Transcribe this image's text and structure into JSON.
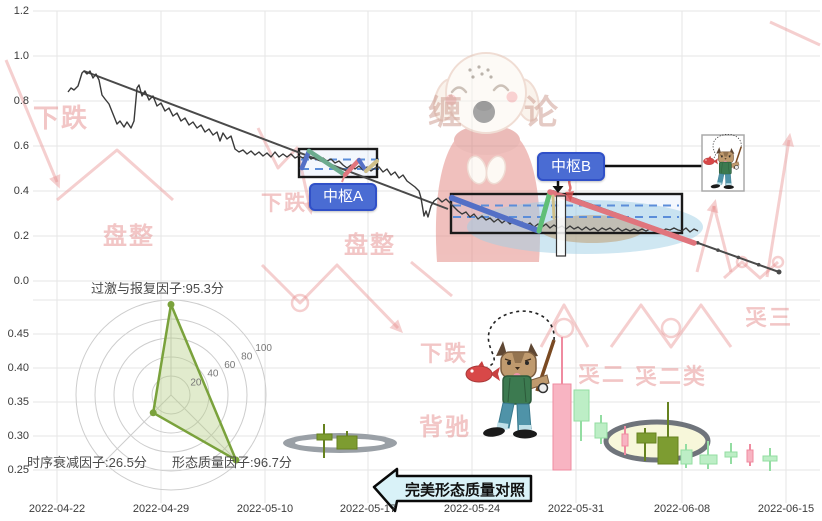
{
  "axes": {
    "x_labels": [
      "2022-04-22",
      "2022-04-29",
      "2022-05-10",
      "2022-05-17",
      "2022-05-24",
      "2022-05-31",
      "2022-06-08",
      "2022-06-15"
    ],
    "x_centers": [
      57,
      161,
      265,
      368,
      472,
      576,
      682,
      786
    ],
    "top_y": {
      "ticks": [
        "1.2",
        "1.0",
        "0.8",
        "0.6",
        "0.4",
        "0.2",
        "0.0"
      ],
      "tick_y": [
        11,
        56,
        101,
        146,
        191,
        236,
        281
      ],
      "range": [
        0,
        1.2
      ]
    },
    "bottom_y": {
      "ticks": [
        "0.45",
        "0.40",
        "0.35",
        "0.30",
        "0.25"
      ],
      "tick_y": [
        334,
        368,
        402,
        436,
        470
      ],
      "extra_grid_y": [
        300
      ]
    },
    "grid_top": 11,
    "grid_bottom": 503,
    "grid_left": 33,
    "grid_right": 820
  },
  "labels": {
    "pivot_a": "中枢A",
    "pivot_b": "中枢B",
    "arrow_callout": "完美形态质量对照",
    "brand_left": "缠",
    "brand_right": "论"
  },
  "chart_data": {
    "type": "line",
    "title": "",
    "y_range": [
      0,
      1.2
    ],
    "price_polyline_px": [
      [
        68,
        92
      ],
      [
        71,
        88
      ],
      [
        74,
        90
      ],
      [
        78,
        86
      ],
      [
        82,
        73
      ],
      [
        84,
        71
      ],
      [
        87,
        74
      ],
      [
        90,
        71
      ],
      [
        93,
        78
      ],
      [
        96,
        74
      ],
      [
        99,
        80
      ],
      [
        102,
        95
      ],
      [
        105,
        99
      ],
      [
        109,
        104
      ],
      [
        113,
        114
      ],
      [
        117,
        124
      ],
      [
        120,
        121
      ],
      [
        124,
        127
      ],
      [
        127,
        122
      ],
      [
        131,
        128
      ],
      [
        134,
        121
      ],
      [
        137,
        88
      ],
      [
        139,
        85
      ],
      [
        142,
        96
      ],
      [
        145,
        91
      ],
      [
        149,
        100
      ],
      [
        153,
        96
      ],
      [
        157,
        106
      ],
      [
        161,
        103
      ],
      [
        165,
        111
      ],
      [
        169,
        108
      ],
      [
        173,
        116
      ],
      [
        177,
        113
      ],
      [
        181,
        121
      ],
      [
        185,
        118
      ],
      [
        189,
        125
      ],
      [
        193,
        122
      ],
      [
        197,
        128
      ],
      [
        201,
        125
      ],
      [
        205,
        132
      ],
      [
        209,
        129
      ],
      [
        213,
        135
      ],
      [
        217,
        132
      ],
      [
        220,
        141
      ],
      [
        223,
        133
      ],
      [
        227,
        139
      ],
      [
        231,
        136
      ],
      [
        235,
        149
      ],
      [
        239,
        152
      ],
      [
        243,
        150
      ],
      [
        247,
        154
      ],
      [
        251,
        151
      ],
      [
        255,
        155
      ],
      [
        259,
        152
      ],
      [
        263,
        156
      ],
      [
        267,
        153
      ],
      [
        271,
        157
      ],
      [
        275,
        152
      ],
      [
        279,
        157
      ],
      [
        283,
        154
      ],
      [
        287,
        157
      ],
      [
        291,
        154
      ],
      [
        295,
        158
      ],
      [
        299,
        156
      ],
      [
        303,
        158
      ],
      [
        307,
        155
      ],
      [
        311,
        159
      ],
      [
        315,
        157
      ],
      [
        319,
        160
      ],
      [
        323,
        158
      ],
      [
        327,
        161
      ],
      [
        331,
        159
      ],
      [
        335,
        163
      ],
      [
        339,
        161
      ],
      [
        343,
        165
      ],
      [
        347,
        168
      ],
      [
        351,
        165
      ],
      [
        355,
        169
      ],
      [
        359,
        166
      ],
      [
        363,
        170
      ],
      [
        367,
        167
      ],
      [
        371,
        171
      ],
      [
        375,
        168
      ],
      [
        379,
        167
      ],
      [
        383,
        172
      ],
      [
        387,
        169
      ],
      [
        391,
        175
      ],
      [
        395,
        172
      ],
      [
        399,
        178
      ],
      [
        403,
        175
      ],
      [
        407,
        181
      ],
      [
        411,
        184
      ],
      [
        415,
        187
      ],
      [
        419,
        191
      ],
      [
        421,
        198
      ],
      [
        424,
        216
      ],
      [
        426,
        211
      ],
      [
        428,
        217
      ],
      [
        431,
        206
      ],
      [
        434,
        201
      ],
      [
        438,
        198
      ],
      [
        442,
        202
      ],
      [
        446,
        199
      ],
      [
        450,
        203
      ],
      [
        454,
        207
      ],
      [
        458,
        211
      ],
      [
        462,
        214
      ],
      [
        466,
        212
      ],
      [
        470,
        217
      ],
      [
        474,
        214
      ],
      [
        478,
        219
      ],
      [
        482,
        216
      ],
      [
        486,
        220
      ],
      [
        490,
        218
      ],
      [
        494,
        222
      ],
      [
        498,
        219
      ],
      [
        502,
        223
      ],
      [
        506,
        220
      ],
      [
        510,
        224
      ],
      [
        514,
        221
      ],
      [
        518,
        225
      ],
      [
        522,
        222
      ],
      [
        526,
        226
      ],
      [
        530,
        223
      ],
      [
        534,
        227
      ],
      [
        538,
        224
      ],
      [
        542,
        227
      ],
      [
        546,
        224
      ],
      [
        550,
        228
      ],
      [
        554,
        225
      ],
      [
        558,
        228
      ],
      [
        562,
        226
      ],
      [
        566,
        229
      ],
      [
        570,
        226
      ],
      [
        574,
        229
      ],
      [
        578,
        227
      ],
      [
        582,
        230
      ],
      [
        586,
        227
      ],
      [
        590,
        230
      ],
      [
        594,
        228
      ],
      [
        598,
        231
      ],
      [
        602,
        228
      ],
      [
        606,
        230
      ],
      [
        610,
        228
      ],
      [
        614,
        231
      ],
      [
        618,
        228
      ],
      [
        622,
        231
      ],
      [
        626,
        229
      ],
      [
        630,
        231
      ],
      [
        634,
        229
      ],
      [
        638,
        231
      ],
      [
        642,
        229
      ],
      [
        646,
        231
      ],
      [
        650,
        229
      ],
      [
        654,
        231
      ],
      [
        658,
        229
      ],
      [
        662,
        231
      ],
      [
        666,
        229
      ],
      [
        670,
        230
      ],
      [
        674,
        228
      ],
      [
        678,
        230
      ],
      [
        682,
        231
      ],
      [
        686,
        228
      ],
      [
        690,
        232
      ],
      [
        694,
        229
      ],
      [
        698,
        231
      ]
    ],
    "trendlines": [
      {
        "from": [
          84,
          71
        ],
        "to": [
          448,
          209
        ],
        "markers": false
      },
      {
        "from": [
          553,
          191
        ],
        "to": [
          779,
          272
        ],
        "markers": true
      }
    ],
    "segments": [
      {
        "c": "blue",
        "w": 4.5,
        "pts": [
          [
            302,
            168
          ],
          [
            309,
            151
          ]
        ]
      },
      {
        "c": "teal",
        "w": 4.5,
        "pts": [
          [
            309,
            151
          ],
          [
            345,
            175
          ]
        ]
      },
      {
        "c": "red_seg",
        "w": 4.5,
        "pts": [
          [
            345,
            175
          ],
          [
            359,
            160
          ]
        ]
      },
      {
        "c": "blue",
        "w": 4,
        "pts": [
          [
            359,
            160
          ],
          [
            366,
            171
          ]
        ]
      },
      {
        "c": "khaki",
        "w": 4,
        "pts": [
          [
            366,
            171
          ],
          [
            377,
            161
          ]
        ]
      },
      {
        "c": "blue",
        "w": 5.5,
        "pts": [
          [
            452,
            198
          ],
          [
            539,
            231
          ]
        ]
      },
      {
        "c": "green_seg",
        "w": 5,
        "pts": [
          [
            539,
            231
          ],
          [
            550,
            192
          ]
        ]
      },
      {
        "c": "red_seg",
        "w": 5.5,
        "pts": [
          [
            550,
            192
          ],
          [
            694,
            243
          ]
        ]
      },
      {
        "c": "khaki",
        "w": 3,
        "pts": [
          [
            553,
            196
          ],
          [
            554,
            218
          ]
        ]
      }
    ],
    "pivot_boxes": [
      {
        "name": "中枢A",
        "x": 299,
        "y": 149,
        "w": 78,
        "h": 28,
        "dash_y": [
          159.5,
          169
        ],
        "dash_x": [
          301,
          383
        ]
      },
      {
        "name": "中枢B",
        "x": 451,
        "y": 194,
        "w": 231,
        "h": 39,
        "dash_y": [
          205.5,
          217
        ],
        "dash_x": [
          453,
          679
        ]
      }
    ],
    "ellipses": [
      {
        "cx": 585,
        "cy": 227,
        "rx": 118,
        "ry": 27,
        "fill": "#9fcfe6",
        "op": 0.5
      },
      {
        "cx": 592,
        "cy": 229,
        "rx": 52,
        "ry": 14,
        "fill": "#bf9e72",
        "op": 0.55
      }
    ],
    "narrow_rect": {
      "x": 556.5,
      "y": 196,
      "w": 9,
      "h": 60
    },
    "mini_frame": {
      "x": 702,
      "y": 135,
      "w": 42,
      "h": 56
    },
    "candles": [
      {
        "cls": "pink",
        "b": [
          553,
          384,
          18,
          86
        ],
        "w": [
          562,
          337,
          384
        ]
      },
      {
        "cls": "lgreen",
        "b": [
          574,
          390,
          15,
          31
        ],
        "w": [
          581,
          421,
          441
        ]
      },
      {
        "cls": "lgreen",
        "b": [
          595,
          423,
          12,
          15
        ],
        "w": [
          601,
          415,
          444
        ]
      },
      {
        "cls": "pink",
        "b": [
          622,
          434,
          6,
          12
        ],
        "w": [
          625,
          426,
          455
        ]
      },
      {
        "cls": "olive",
        "b": [
          637,
          433,
          19,
          10
        ],
        "w": [
          645,
          428,
          461
        ]
      },
      {
        "cls": "olive",
        "b": [
          658,
          437,
          20,
          27
        ],
        "w": [
          668,
          402,
          437
        ]
      },
      {
        "cls": "lgreen",
        "b": [
          681,
          450,
          11,
          14
        ],
        "w": [
          686,
          444,
          468
        ]
      },
      {
        "cls": "lgreen",
        "b": [
          700,
          455,
          17,
          9
        ],
        "w": [
          708,
          441,
          469
        ]
      },
      {
        "cls": "lgreen",
        "b": [
          725,
          452,
          12,
          5
        ],
        "w": [
          731,
          443,
          464
        ]
      },
      {
        "cls": "pink",
        "b": [
          747,
          450,
          6,
          12
        ],
        "w": [
          750,
          444,
          466
        ]
      },
      {
        "cls": "lgreen",
        "b": [
          763,
          456,
          14,
          5
        ],
        "w": [
          770,
          448,
          471
        ]
      },
      {
        "cls": "olive",
        "b": [
          317,
          434,
          15,
          6
        ],
        "w": [
          324,
          424,
          458
        ]
      },
      {
        "cls": "olive",
        "b": [
          337,
          436,
          20,
          13
        ],
        "w": [
          347,
          431,
          436
        ]
      }
    ],
    "gray_ring_left": {
      "cx": 340,
      "cy": 443,
      "rx": 57,
      "ry": 10,
      "inner_rx": 45,
      "inner_ry": 4.5
    },
    "gray_ellipse_right": {
      "cx": 657,
      "cy": 441,
      "rx": 51,
      "ry": 19
    },
    "radar": {
      "center": [
        171,
        395
      ],
      "px_per_unit": 0.95,
      "rings": [
        20,
        40,
        60,
        80,
        100
      ],
      "tick_angle_deg": -27,
      "factors": [
        {
          "label": "过激与报复因子:95.3分",
          "value": 95.3,
          "angle": -90,
          "label_x": 91,
          "label_y": 278
        },
        {
          "label": "形态质量因子:96.7分",
          "value": 96.7,
          "angle": 45,
          "label_x": 172,
          "label_y": 452
        },
        {
          "label": "时序衰减因子:26.5分",
          "value": 26.5,
          "angle": 135,
          "label_x": 27,
          "label_y": 452
        }
      ]
    },
    "callout": {
      "poly": "374,487 397,469 397,476 531,476 531,501 397,501 395,511"
    }
  },
  "watermark_texts": [
    {
      "text": "下跌",
      "x": 33,
      "y": 98,
      "size": 26,
      "mirror": false
    },
    {
      "text": "盘整",
      "x": 103,
      "y": 216,
      "size": 24,
      "mirror": false
    },
    {
      "text": "下跌",
      "x": 261,
      "y": 187,
      "size": 21,
      "mirror": false
    },
    {
      "text": "盘整",
      "x": 344,
      "y": 225,
      "size": 24,
      "mirror": false
    },
    {
      "text": "下跌",
      "x": 420,
      "y": 336,
      "size": 22,
      "mirror": false
    },
    {
      "text": "背驰",
      "x": 419,
      "y": 407,
      "size": 24,
      "mirror": false
    },
    {
      "text": "二买",
      "x": 576,
      "y": 357,
      "size": 22,
      "mirror": true
    },
    {
      "text": "类二买",
      "x": 633,
      "y": 359,
      "size": 22,
      "mirror": true
    },
    {
      "text": "三买",
      "x": 743,
      "y": 300,
      "size": 22,
      "mirror": true
    }
  ],
  "watermark_shapes": {
    "polylines": [
      {
        "pts": [
          [
            6,
            60
          ],
          [
            57,
            182
          ]
        ],
        "arrow": true
      },
      {
        "pts": [
          [
            57,
            200
          ],
          [
            117,
            150
          ],
          [
            173,
            200
          ]
        ],
        "arrow": false
      },
      {
        "pts": [
          [
            258,
            128
          ],
          [
            278,
            168
          ],
          [
            297,
            148
          ],
          [
            310,
            208
          ]
        ],
        "arrow": true
      },
      {
        "pts": [
          [
            697,
            272
          ],
          [
            714,
            206
          ]
        ],
        "arrow": true
      },
      {
        "pts": [
          [
            714,
            206
          ],
          [
            731,
            272
          ]
        ],
        "arrow": false
      },
      {
        "pts": [
          [
            767,
            277
          ],
          [
            789,
            140
          ]
        ],
        "arrow": true
      },
      {
        "pts": [
          [
            770,
            22
          ],
          [
            820,
            45
          ]
        ],
        "arrow": false
      },
      {
        "pts": [
          [
            262,
            265
          ],
          [
            300,
            303
          ],
          [
            337,
            265
          ],
          [
            398,
            328
          ]
        ],
        "arrow": true
      },
      {
        "pts": [
          [
            541,
            347
          ],
          [
            564,
            305
          ],
          [
            588,
            347
          ]
        ],
        "arrow": false
      },
      {
        "pts": [
          [
            611,
            347
          ],
          [
            641,
            305
          ],
          [
            671,
            347
          ],
          [
            701,
            305
          ],
          [
            731,
            347
          ]
        ],
        "arrow": false
      },
      {
        "pts": [
          [
            724,
            278
          ],
          [
            742,
            262
          ],
          [
            760,
            278
          ],
          [
            778,
            262
          ]
        ],
        "arrow": false
      },
      {
        "pts": [
          [
            411,
            262
          ],
          [
            452,
            296
          ]
        ],
        "arrow": false
      }
    ],
    "circles": [
      [
        300,
        303,
        8
      ],
      [
        564,
        328,
        9
      ],
      [
        671,
        328,
        9
      ],
      [
        742,
        262,
        5
      ],
      [
        778,
        262,
        5
      ]
    ]
  },
  "colors": {
    "grid": "#e5e5e5",
    "price": "#3a3a3a",
    "trend": "#4a4a4a",
    "blue": "#5470c6",
    "teal": "#6cab8e",
    "red_seg": "#e0757d",
    "green_seg": "#5fbf77",
    "khaki": "#cfc08a",
    "dash": "#5b8dd9",
    "box_fill": "rgba(160,190,235,0.12)",
    "candle_pink_fill": "#f8b4c2",
    "candle_pink_stroke": "#ef8ba0",
    "candle_green_fill": "#bdeec6",
    "candle_green_stroke": "#93dda2",
    "candle_olive_fill": "#7d9c31",
    "candle_olive_stroke": "#66821f",
    "radar": "#7aa23c",
    "radar_fill": "rgba(180,205,130,0.4)",
    "radar_ring": "#cdcdcd",
    "watermark": "rgba(232,140,140,0.42)",
    "callout_fill": "#d9f2f8",
    "ring_gray": "#9aa0a6",
    "ellipse_gray_stroke": "#6f747b",
    "ellipse_gray_fill": "#f7f7da"
  }
}
